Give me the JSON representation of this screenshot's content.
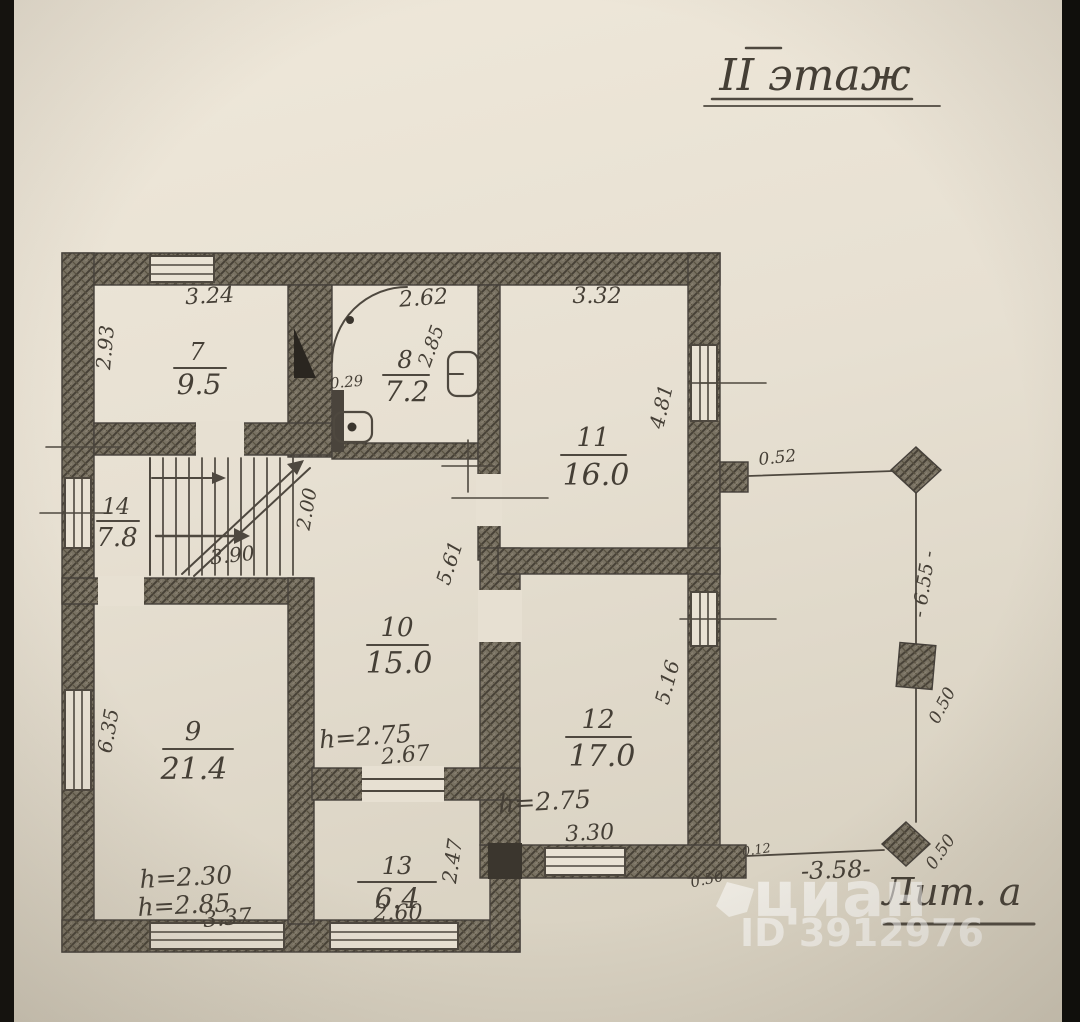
{
  "title": "II этаж",
  "liter": "Лит. а",
  "watermark": {
    "brand": "циан",
    "id": "ID 3912976"
  },
  "rooms": {
    "r7": {
      "num": "7",
      "area": "9.5"
    },
    "r8": {
      "num": "8",
      "area": "7.2"
    },
    "r9": {
      "num": "9",
      "area": "21.4"
    },
    "r10": {
      "num": "10",
      "area": "15.0"
    },
    "r11": {
      "num": "11",
      "area": "16.0"
    },
    "r12": {
      "num": "12",
      "area": "17.0"
    },
    "r13": {
      "num": "13",
      "area": "6.4"
    },
    "r14": {
      "num": "14",
      "area": "7.8"
    }
  },
  "dims": {
    "d7_top": "3.24",
    "d7_left": "2.93",
    "d8_top": "2.62",
    "d8_right": "2.85",
    "d8_vent": "0.29",
    "d11_top": "3.32",
    "d11_right": "4.81",
    "d14_bottom": "3.90",
    "d14_right": "2.00",
    "d10_right": "5.61",
    "d10_h": "h=2.75",
    "d10_bottom": "2.67",
    "d9_left": "6.35",
    "d9_h1": "h=2.30",
    "d9_h2": "h=2.85",
    "d9_bottom": "3.37",
    "d12_right": "5.16",
    "d12_h": "h=2.75",
    "d12_bottom": "3.30",
    "d13_right": "2.47",
    "d13_bottom": "2.60",
    "t_top": "0.52",
    "t_right": "- 6.55 -",
    "t_post_upper": "0.50",
    "t_bottom": "-3.58-",
    "t_small": "0.12",
    "t_corner": "0.50",
    "t_post_lower": "0.50"
  },
  "colors": {
    "paper": "#e8e1d3",
    "pencil": "#4e483f",
    "wall": "#6f6859",
    "edge": "#15130f"
  }
}
